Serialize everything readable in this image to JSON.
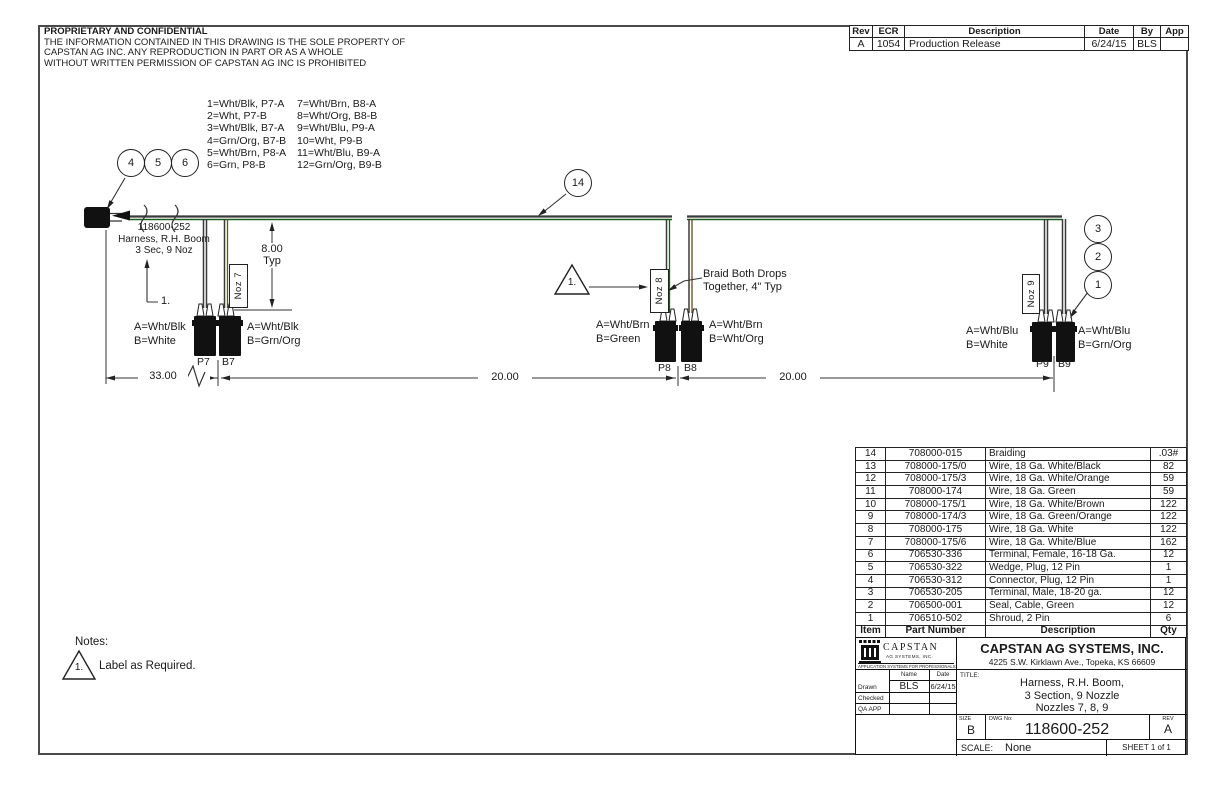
{
  "proprietary": {
    "title": "PROPRIETARY AND CONFIDENTIAL",
    "line1": "THE INFORMATION CONTAINED IN THIS DRAWING IS THE SOLE PROPERTY OF",
    "line2": "CAPSTAN AG INC. ANY REPRODUCTION IN PART OR AS A WHOLE",
    "line3": "WITHOUT WRITTEN PERMISSION OF CAPSTAN AG INC IS PROHIBITED"
  },
  "revision_table": {
    "headers": {
      "rev": "Rev",
      "ecr": "ECR",
      "description": "Description",
      "date": "Date",
      "by": "By",
      "app": "App"
    },
    "row": {
      "rev": "A",
      "ecr": "1054",
      "description": "Production Release",
      "date": "6/24/15",
      "by": "BLS",
      "app": ""
    }
  },
  "legend": {
    "col1": [
      "1=Wht/Blk, P7-A",
      "2=Wht, P7-B",
      "3=Wht/Blk, B7-A",
      "4=Grn/Org, B7-B",
      "5=Wht/Brn, P8-A",
      "6=Grn, P8-B"
    ],
    "col2": [
      "7=Wht/Brn, B8-A",
      "8=Wht/Org, B8-B",
      "9=Wht/Blu, P9-A",
      "10=Wht, P9-B",
      "11=Wht/Blu, B9-A",
      "12=Grn/Org, B9-B"
    ]
  },
  "balloons": {
    "b1": "1",
    "b2": "2",
    "b3": "3",
    "b4": "4",
    "b5": "5",
    "b6": "6",
    "b14": "14"
  },
  "harness_callout": {
    "line1": "118600-252",
    "line2": "Harness, R.H. Boom",
    "line3": "3 Sec, 9 Noz",
    "leader_note": "1."
  },
  "flags": {
    "mid": "1.",
    "notes": "1."
  },
  "noz7": {
    "label": "Noz 7",
    "p_name": "P7",
    "b_name": "B7",
    "p_a": "A=Wht/Blk",
    "p_b": "B=White",
    "b_a": "A=Wht/Blk",
    "b_b": "B=Grn/Org"
  },
  "noz8": {
    "label": "Noz 8",
    "p_name": "P8",
    "b_name": "B8",
    "p_a": "A=Wht/Brn",
    "p_b": "B=Green",
    "b_a": "A=Wht/Brn",
    "b_b": "B=Wht/Org"
  },
  "noz9": {
    "label": "Noz 9",
    "p_name": "P9",
    "b_name": "B9",
    "p_a": "A=Wht/Blu",
    "p_b": "B=White",
    "b_a": "A=Wht/Blu",
    "b_b": "B=Grn/Org"
  },
  "braid_note": {
    "line1": "Braid Both Drops",
    "line2": "Together, 4\" Typ"
  },
  "dims": {
    "d33": "33.00",
    "d20a": "20.00",
    "d20b": "20.00",
    "typ_val": "8.00",
    "typ_lbl": "Typ"
  },
  "bom": {
    "headers": [
      "Item",
      "Part Number",
      "Description",
      "Qty"
    ],
    "rows": [
      [
        "14",
        "708000-015",
        "Braiding",
        ".03#"
      ],
      [
        "13",
        "708000-175/0",
        "Wire, 18 Ga. White/Black",
        "82"
      ],
      [
        "12",
        "708000-175/3",
        "Wire, 18 Ga. White/Orange",
        "59"
      ],
      [
        "11",
        "708000-174",
        "Wire, 18 Ga. Green",
        "59"
      ],
      [
        "10",
        "708000-175/1",
        "Wire, 18 Ga. White/Brown",
        "122"
      ],
      [
        "9",
        "708000-174/3",
        "Wire, 18 Ga. Green/Orange",
        "122"
      ],
      [
        "8",
        "708000-175",
        "Wire, 18 Ga. White",
        "122"
      ],
      [
        "7",
        "708000-175/6",
        "Wire, 18 Ga. White/Blue",
        "162"
      ],
      [
        "6",
        "706530-336",
        "Terminal, Female, 16-18 Ga.",
        "12"
      ],
      [
        "5",
        "706530-322",
        "Wedge, Plug, 12 Pin",
        "1"
      ],
      [
        "4",
        "706530-312",
        "Connector, Plug, 12 Pin",
        "1"
      ],
      [
        "3",
        "706530-205",
        "Terminal, Male, 18-20 ga.",
        "12"
      ],
      [
        "2",
        "706500-001",
        "Seal, Cable, Green",
        "12"
      ],
      [
        "1",
        "706510-502",
        "Shroud, 2 Pin",
        "6"
      ]
    ]
  },
  "title_block": {
    "logo_name": "CAPSTAN",
    "logo_sub": "AG SYSTEMS, INC.",
    "logo_tagline": "APPLICATION SYSTEMS FOR PROFESSIONALS",
    "company": "CAPSTAN AG SYSTEMS, INC.",
    "address": "4225 S.W. Kirklawn Ave., Topeka, KS 66609",
    "name_label": "Name",
    "date_label": "Date",
    "drawn_label": "Drawn",
    "checked_label": "Checked",
    "qa_label": "QA APP",
    "drawn_name": "BLS",
    "drawn_date": "6/24/15",
    "title_label": "TITLE:",
    "title_line1": "Harness, R.H. Boom,",
    "title_line2": "3 Section, 9 Nozzle",
    "title_line3": "Nozzles 7, 8, 9",
    "size_label": "SIZE",
    "size": "B",
    "dwg_label": "DWG No:",
    "dwg_no": "118600-252",
    "rev_label": "REV",
    "rev": "A",
    "scale_label": "SCALE:",
    "scale": "None",
    "sheet": "SHEET 1 of 1"
  },
  "notes": {
    "heading": "Notes:",
    "text": "Label as Required."
  },
  "colors": {
    "wire_green": "#1b5e20",
    "wire_dark": "#3a3a3a",
    "ink": "#1a1a1a"
  }
}
